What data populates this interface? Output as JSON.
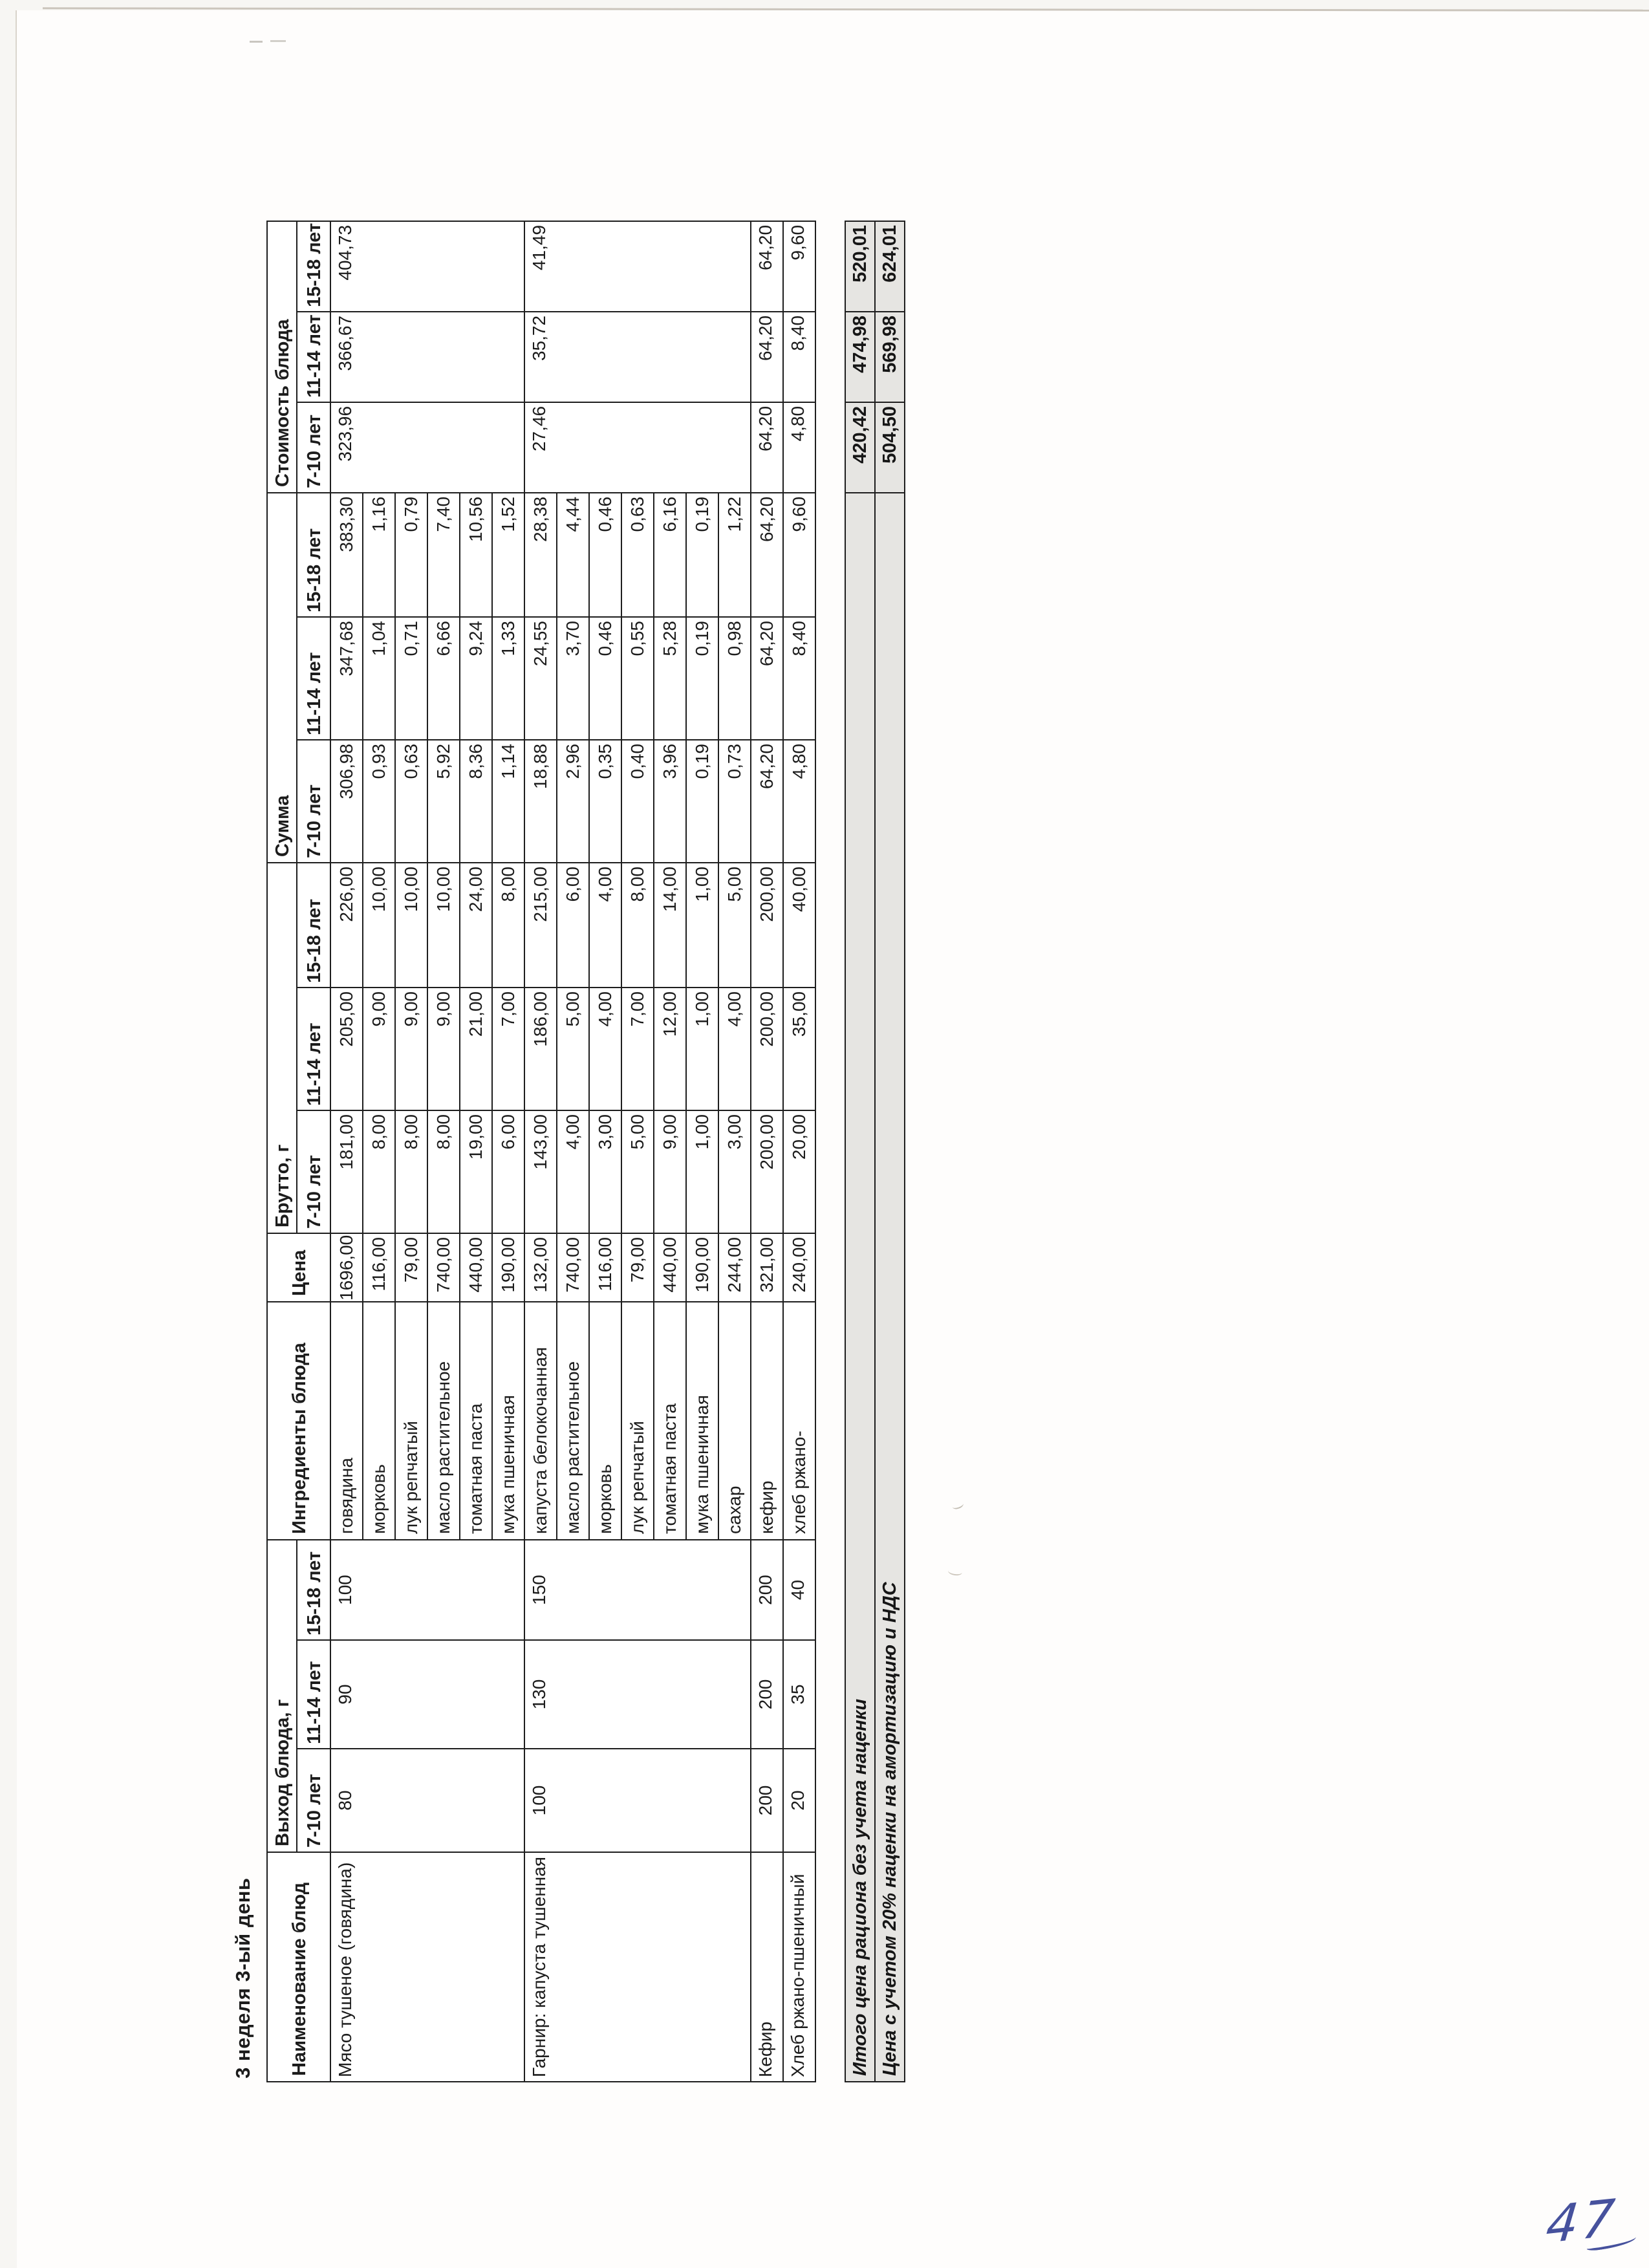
{
  "page": {
    "title": "3 неделя 3-ый день",
    "handwritten_number": "47"
  },
  "table": {
    "headers": {
      "name": "Наименование блюд",
      "vykhod_group": "Выход блюда, г",
      "ingredients": "Ингредиенты блюда",
      "price": "Цена",
      "brutto_group": "Брутто, г",
      "summa_group": "Сумма",
      "cost_group": "Стоимость блюда",
      "age_cols": [
        "7-10 лет",
        "11-14 лет",
        "15-18 лет"
      ]
    },
    "dishes": [
      {
        "name": "Мясо тушеное (говядина)",
        "vykhod": [
          "80",
          "90",
          "100"
        ],
        "cost": [
          "323,96",
          "366,67",
          "404,73"
        ]
      },
      {
        "name": "Гарнир: капуста тушенная",
        "vykhod": [
          "100",
          "130",
          "150"
        ],
        "cost": [
          "27,46",
          "35,72",
          "41,49"
        ]
      },
      {
        "name": "Кефир",
        "vykhod": [
          "200",
          "200",
          "200"
        ],
        "cost": [
          "64,20",
          "64,20",
          "64,20"
        ]
      },
      {
        "name": "Хлеб ржано-пшеничный",
        "vykhod": [
          "20",
          "35",
          "40"
        ],
        "cost": [
          "4,80",
          "8,40",
          "9,60"
        ]
      }
    ],
    "rows": [
      {
        "ingredient": "говядина",
        "price": "1696,00",
        "brutto": [
          "181,00",
          "205,00",
          "226,00"
        ],
        "summa": [
          "306,98",
          "347,68",
          "383,30"
        ]
      },
      {
        "ingredient": "морковь",
        "price": "116,00",
        "brutto": [
          "8,00",
          "9,00",
          "10,00"
        ],
        "summa": [
          "0,93",
          "1,04",
          "1,16"
        ]
      },
      {
        "ingredient": "лук репчатый",
        "price": "79,00",
        "brutto": [
          "8,00",
          "9,00",
          "10,00"
        ],
        "summa": [
          "0,63",
          "0,71",
          "0,79"
        ]
      },
      {
        "ingredient": "масло растительное",
        "price": "740,00",
        "brutto": [
          "8,00",
          "9,00",
          "10,00"
        ],
        "summa": [
          "5,92",
          "6,66",
          "7,40"
        ]
      },
      {
        "ingredient": "томатная паста",
        "price": "440,00",
        "brutto": [
          "19,00",
          "21,00",
          "24,00"
        ],
        "summa": [
          "8,36",
          "9,24",
          "10,56"
        ]
      },
      {
        "ingredient": "мука пшеничная",
        "price": "190,00",
        "brutto": [
          "6,00",
          "7,00",
          "8,00"
        ],
        "summa": [
          "1,14",
          "1,33",
          "1,52"
        ]
      },
      {
        "ingredient": "капуста белокочанная",
        "price": "132,00",
        "brutto": [
          "143,00",
          "186,00",
          "215,00"
        ],
        "summa": [
          "18,88",
          "24,55",
          "28,38"
        ]
      },
      {
        "ingredient": "масло растительное",
        "price": "740,00",
        "brutto": [
          "4,00",
          "5,00",
          "6,00"
        ],
        "summa": [
          "2,96",
          "3,70",
          "4,44"
        ]
      },
      {
        "ingredient": "морковь",
        "price": "116,00",
        "brutto": [
          "3,00",
          "4,00",
          "4,00"
        ],
        "summa": [
          "0,35",
          "0,46",
          "0,46"
        ]
      },
      {
        "ingredient": "лук репчатый",
        "price": "79,00",
        "brutto": [
          "5,00",
          "7,00",
          "8,00"
        ],
        "summa": [
          "0,40",
          "0,55",
          "0,63"
        ]
      },
      {
        "ingredient": "томатная паста",
        "price": "440,00",
        "brutto": [
          "9,00",
          "12,00",
          "14,00"
        ],
        "summa": [
          "3,96",
          "5,28",
          "6,16"
        ]
      },
      {
        "ingredient": "мука пшеничная",
        "price": "190,00",
        "brutto": [
          "1,00",
          "1,00",
          "1,00"
        ],
        "summa": [
          "0,19",
          "0,19",
          "0,19"
        ]
      },
      {
        "ingredient": "сахар",
        "price": "244,00",
        "brutto": [
          "3,00",
          "4,00",
          "5,00"
        ],
        "summa": [
          "0,73",
          "0,98",
          "1,22"
        ]
      },
      {
        "ingredient": "кефир",
        "price": "321,00",
        "brutto": [
          "200,00",
          "200,00",
          "200,00"
        ],
        "summa": [
          "64,20",
          "64,20",
          "64,20"
        ]
      },
      {
        "ingredient": "хлеб ржано-",
        "price": "240,00",
        "brutto": [
          "20,00",
          "35,00",
          "40,00"
        ],
        "summa": [
          "4,80",
          "8,40",
          "9,60"
        ]
      }
    ],
    "totals": [
      {
        "label": "Итого цена рациона без учета наценки",
        "values": [
          "420,42",
          "474,98",
          "520,01"
        ]
      },
      {
        "label": "Цена с учетом 20% наценки на амортизацию и НДС",
        "values": [
          "504,50",
          "569,98",
          "624,01"
        ]
      }
    ]
  }
}
